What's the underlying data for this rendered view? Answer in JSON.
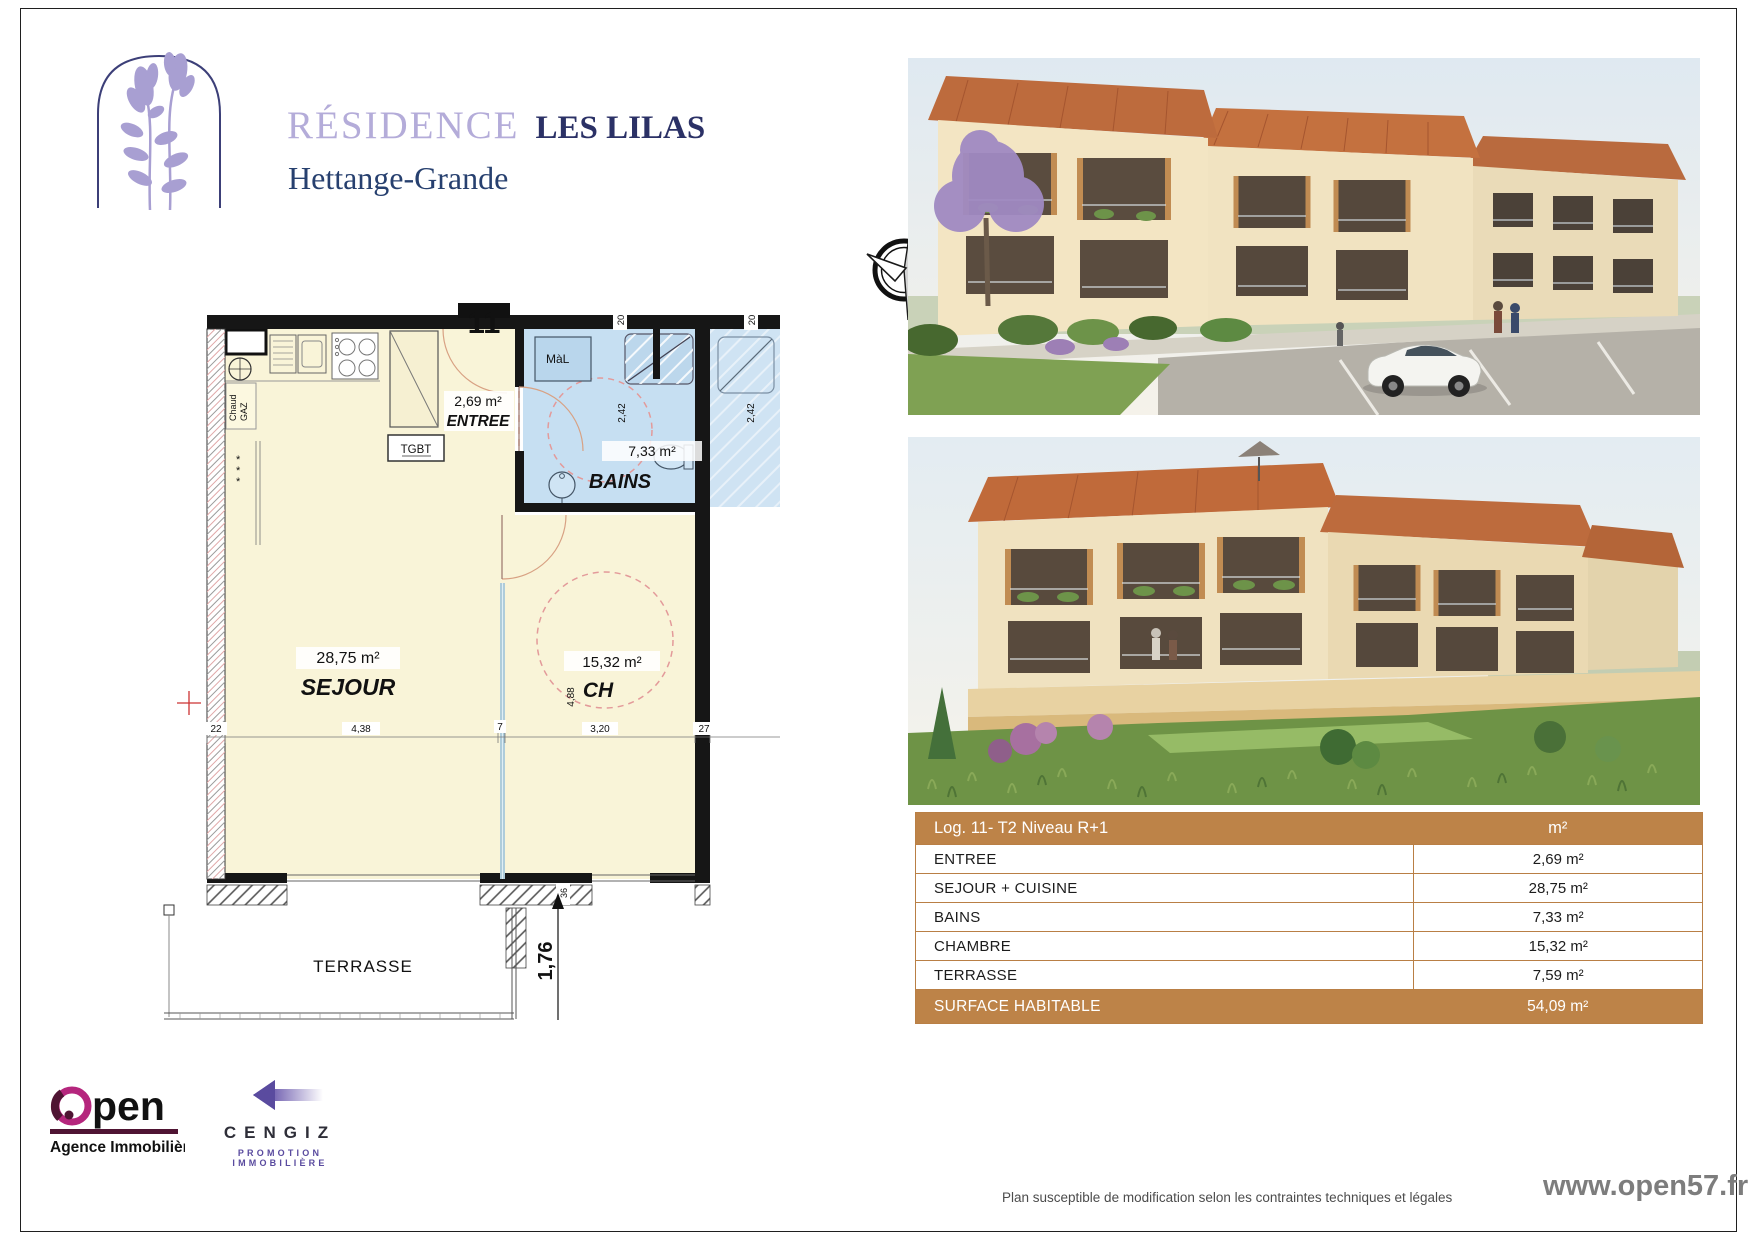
{
  "brand": {
    "residence": "RÉSIDENCE",
    "name": "LES LILAS",
    "city": "Hettange-Grande"
  },
  "floorplan": {
    "unit_number": "11",
    "north": "N",
    "rooms": {
      "entree": {
        "label": "ENTREE",
        "area": "2,69 m²"
      },
      "bains": {
        "label": "BAINS",
        "area": "7,33 m²"
      },
      "sejour": {
        "label": "SEJOUR",
        "area": "28,75 m²"
      },
      "chambre": {
        "label": "CH",
        "area": "15,32 m²"
      },
      "terrasse": {
        "label": "TERRASSE"
      }
    },
    "equipment": {
      "boiler_line1": "Chaud",
      "boiler_line2": "GAZ",
      "electrical_panel": "TGBT",
      "washing_machine": "MàL"
    },
    "dims": {
      "top_left": "20",
      "top_right": "20",
      "bains_left": "2,42",
      "bains_right": "2,42",
      "ch_height": "4,88",
      "left_wall": "22",
      "sejour_width": "4,38",
      "partition": "7",
      "ch_width": "3,20",
      "right_wall": "27",
      "door_offset": "36",
      "terrace_depth": "1,76"
    }
  },
  "table": {
    "header": {
      "title": "Log. 11- T2 Niveau R+1",
      "unit": "m²"
    },
    "rows": [
      {
        "label": "ENTREE",
        "value": "2,69 m²"
      },
      {
        "label": "SEJOUR + CUISINE",
        "value": "28,75 m²"
      },
      {
        "label": "BAINS",
        "value": "7,33 m²"
      },
      {
        "label": "CHAMBRE",
        "value": "15,32 m²"
      },
      {
        "label": "TERRASSE",
        "value": "7,59 m²"
      }
    ],
    "footer": {
      "label": "SURFACE HABITABLE",
      "value": "54,09 m²"
    }
  },
  "logos": {
    "open": {
      "name": "Open",
      "tagline": "Agence Immobilière"
    },
    "cengiz": {
      "name": "CENGIZ",
      "tagline": "PROMOTION IMMOBILIÈRE"
    }
  },
  "footer": {
    "disclaimer": "Plan susceptible de modification selon les contraintes techniques et légales",
    "website": "www.open57.fr"
  },
  "colors": {
    "table_brown": "#bd8348",
    "room_cream": "#f9f4d8",
    "room_blue": "#c6dff2",
    "title_purple": "#b4acd9",
    "title_navy": "#2b3166",
    "open_magenta": "#b5267d",
    "open_maroon": "#4f1433",
    "cengiz_purple": "#5a4b9f"
  }
}
